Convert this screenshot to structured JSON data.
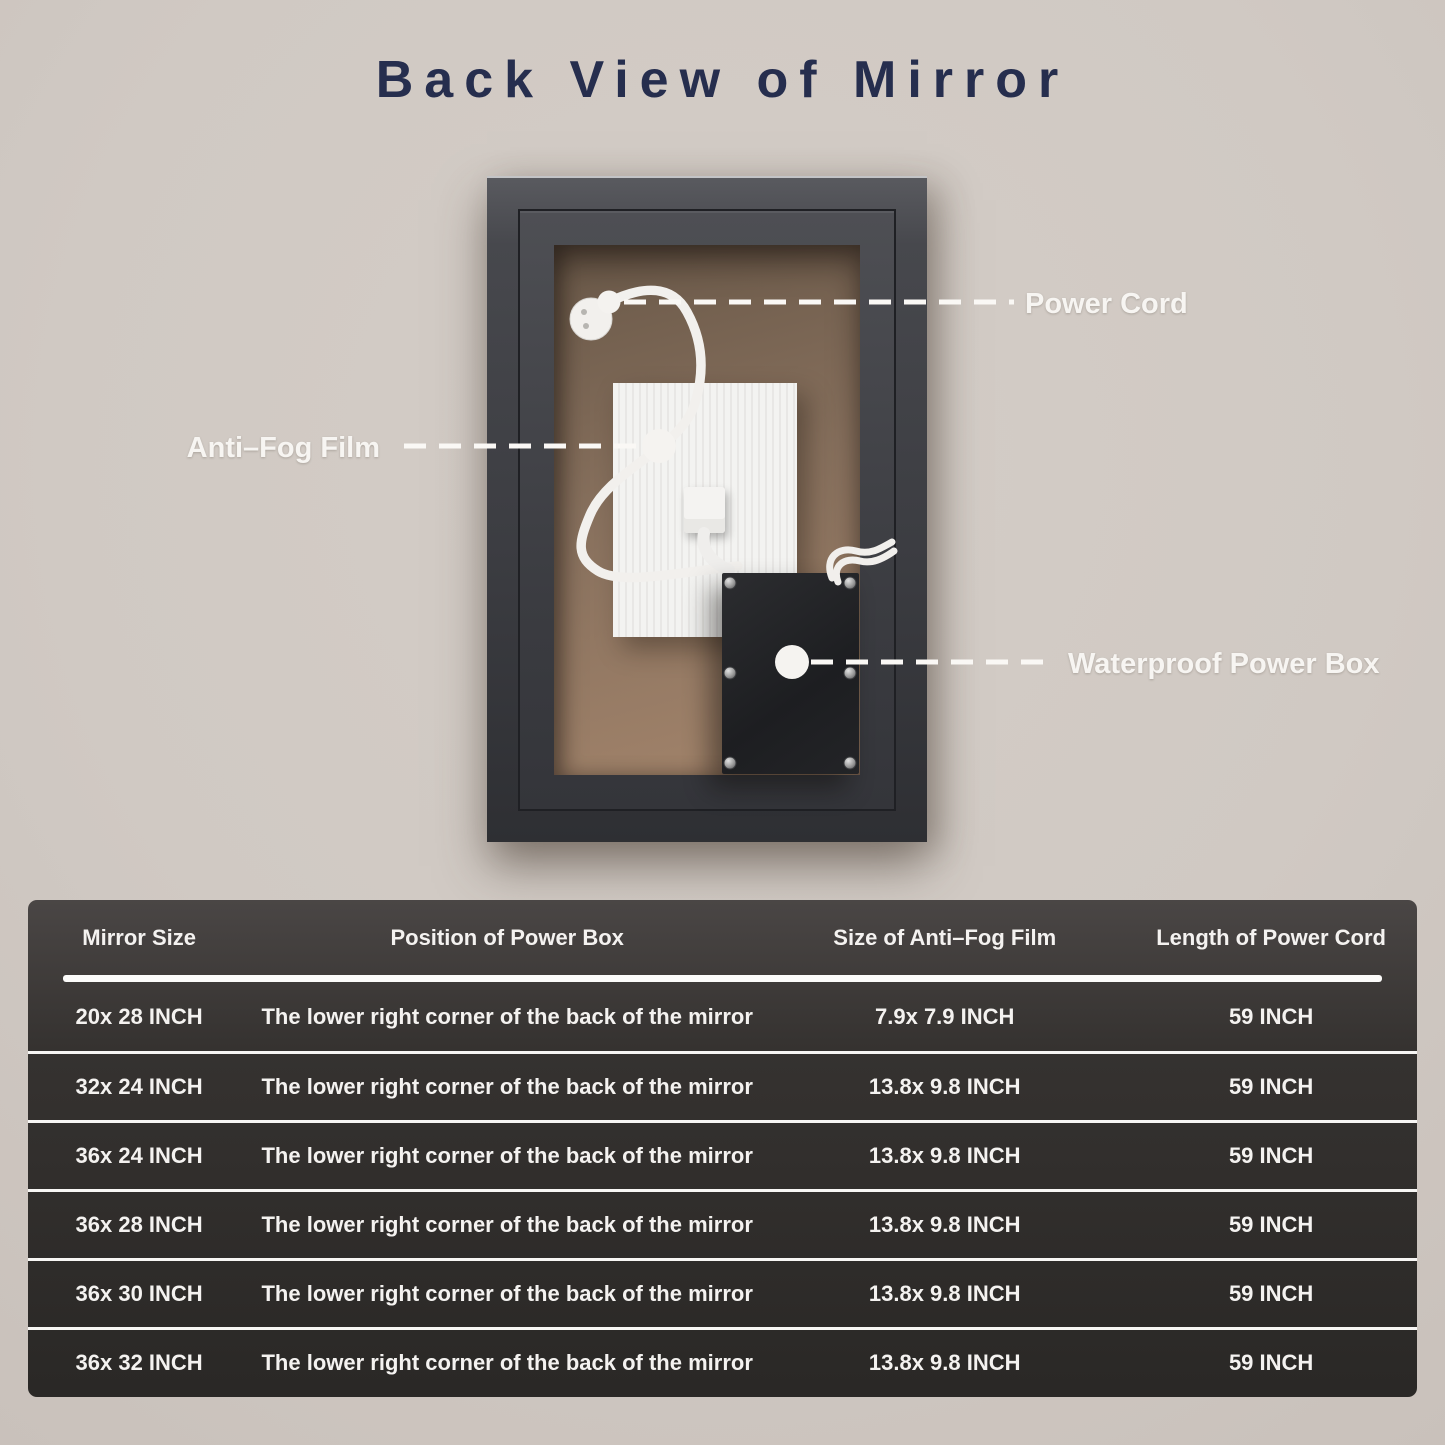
{
  "page": {
    "title": "Back View of Mirror",
    "background_color": "#d0c9c3",
    "title_color": "#262e4e"
  },
  "diagram": {
    "callouts": [
      {
        "label": "Power Cord"
      },
      {
        "label": "Anti–Fog Film"
      },
      {
        "label": "Waterproof Power Box"
      }
    ],
    "label_color": "#f7f5f2",
    "colors": {
      "frame": "#3c3d42",
      "back_panel": "#8a7460",
      "anti_fog_film": "#f0efed",
      "power_box": "#1f2023",
      "cord": "#f2f0ed"
    }
  },
  "table": {
    "headers": [
      "Mirror Size",
      "Position of Power Box",
      "Size of Anti–Fog Film",
      "Length of Power Cord"
    ],
    "rows": [
      [
        "20x 28 INCH",
        "The lower right corner of the back of the mirror",
        "7.9x 7.9 INCH",
        "59 INCH"
      ],
      [
        "32x 24 INCH",
        "The lower right corner of the back of the mirror",
        "13.8x 9.8 INCH",
        "59 INCH"
      ],
      [
        "36x 24 INCH",
        "The lower right corner of the back of the mirror",
        "13.8x 9.8 INCH",
        "59 INCH"
      ],
      [
        "36x 28 INCH",
        "The lower right corner of the back of the mirror",
        "13.8x 9.8 INCH",
        "59 INCH"
      ],
      [
        "36x 30 INCH",
        "The lower right corner of the back of the mirror",
        "13.8x 9.8 INCH",
        "59 INCH"
      ],
      [
        "36x 32 INCH",
        "The lower right corner of the back of the mirror",
        "13.8x 9.8 INCH",
        "59 INCH"
      ]
    ],
    "text_color": "#f4f2f0"
  }
}
